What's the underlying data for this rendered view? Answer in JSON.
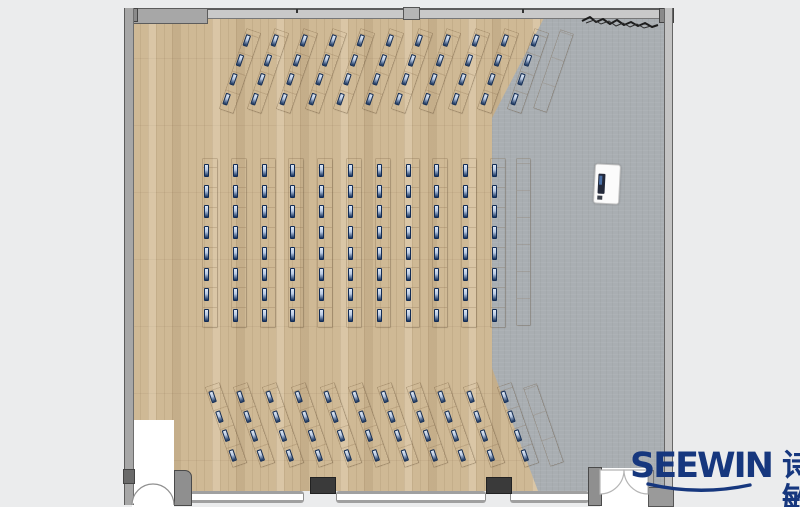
{
  "logo": {
    "brand": "SEEWIN",
    "cjk": "诗敏"
  },
  "colors": {
    "bg": "#ebeced",
    "wood": "#cfb995",
    "floor_gray": "#a9aeb2",
    "wall_light": "#c9c9c9",
    "wall_mid": "#a7a7a7",
    "wall_dark": "#5c5c5c",
    "column_dark": "#3a3a3a",
    "monitor_navy": "#16335f",
    "monitor_screen": "#dce6f3",
    "logo_blue": "#16377e"
  },
  "plan": {
    "desk_sections": [
      {
        "name": "front-fan-rows",
        "rotation": 19,
        "strip_w": 14,
        "strip_h": 84,
        "seats_per_strip": 4,
        "monitor_h": 12,
        "cy": 71,
        "cx": [
          239.5,
          268.2,
          296.9,
          325.6,
          354.3,
          383,
          411.7,
          440.4,
          469.1,
          497.8,
          528
        ]
      },
      {
        "name": "center-columns",
        "rotation": 0,
        "strip_w": 14,
        "strip_h": 168,
        "seats_per_strip": 8,
        "monitor_h": 13,
        "cy": 243,
        "cx": [
          210,
          238.8,
          267.6,
          296.4,
          325.2,
          354,
          382.8,
          411.6,
          440.4,
          469.2,
          498
        ]
      },
      {
        "name": "rear-fan-rows",
        "rotation": -19,
        "strip_w": 14,
        "strip_h": 84,
        "seats_per_strip": 4,
        "monitor_h": 12,
        "cy": 425,
        "cx": [
          225.7,
          254.4,
          283.1,
          311.8,
          340.5,
          369.2,
          397.9,
          426.6,
          455.3,
          484,
          518
        ]
      }
    ],
    "side_tables": [
      {
        "cx": 553,
        "cy": 71,
        "w": 13,
        "h": 82,
        "rotation": 19
      },
      {
        "cx": 523,
        "cy": 242,
        "w": 13,
        "h": 166,
        "rotation": 0
      },
      {
        "cx": 543,
        "cy": 425,
        "w": 13,
        "h": 82,
        "rotation": -19
      }
    ]
  }
}
